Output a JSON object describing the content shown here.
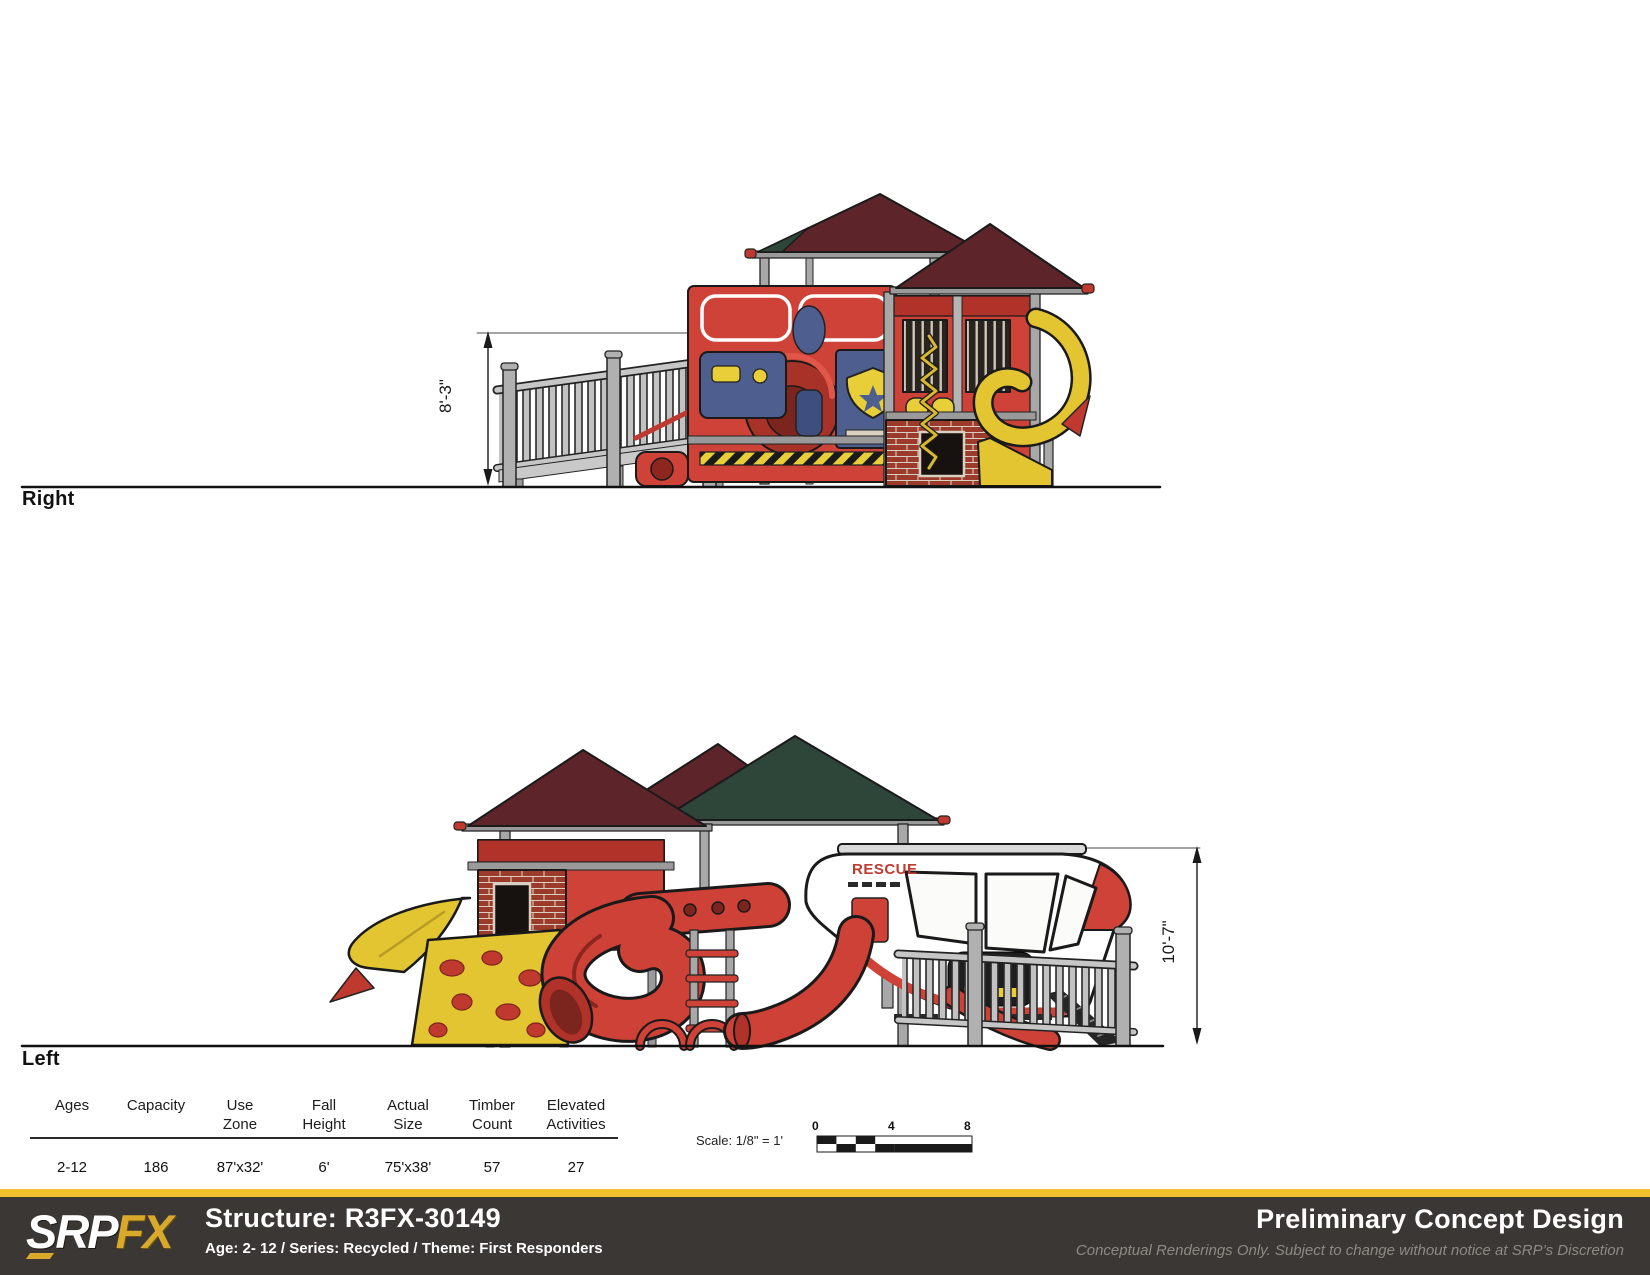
{
  "views": {
    "right": {
      "label": "Right",
      "dimension": "8'-3\""
    },
    "left": {
      "label": "Left",
      "dimension": "10'-7\"",
      "rescue_label": "RESCUE"
    }
  },
  "spec_table": {
    "columns": [
      {
        "line1": "",
        "line2": "Ages",
        "value": "2-12"
      },
      {
        "line1": "",
        "line2": "Capacity",
        "value": "186"
      },
      {
        "line1": "Use",
        "line2": "Zone",
        "value": "87'x32'"
      },
      {
        "line1": "Fall",
        "line2": "Height",
        "value": "6'"
      },
      {
        "line1": "Actual",
        "line2": "Size",
        "value": "75'x38'"
      },
      {
        "line1": "Timber",
        "line2": "Count",
        "value": "57"
      },
      {
        "line1": "Elevated",
        "line2": "Activities",
        "value": "27"
      }
    ]
  },
  "scale": {
    "label": "Scale: 1/8\" = 1'",
    "ticks": [
      "0",
      "4",
      "8"
    ]
  },
  "footer": {
    "logo_srp": "SRP",
    "logo_fx": "FX",
    "structure_title": "Structure: R3FX-30149",
    "structure_subtitle": "Age: 2- 12 / Series: Recycled / Theme: First Responders",
    "right_title": "Preliminary Concept Design",
    "right_subtitle": "Conceptual Renderings Only. Subject to change without notice at SRP’s Discretion"
  },
  "colors": {
    "accent_gold": "#F2C12E",
    "footer_bg": "#3B3734",
    "structure_red": "#CE4238",
    "roof_maroon": "#5D2429",
    "roof_green": "#2E453A",
    "panel_blue": "#4E5E8E",
    "slide_yellow": "#E3C431",
    "post_gray": "#ABABAB"
  }
}
